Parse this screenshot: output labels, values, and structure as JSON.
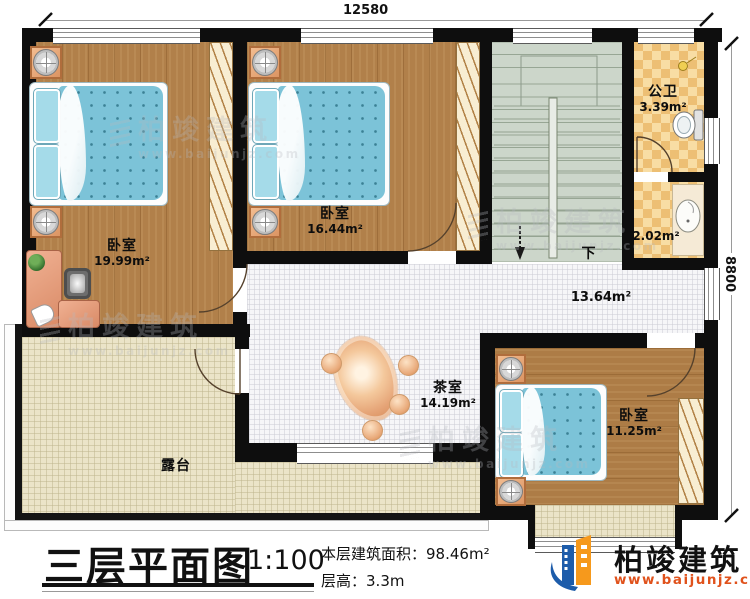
{
  "dimensions": {
    "width": "12580",
    "height": "8800"
  },
  "rooms": {
    "bedroom1": {
      "label": "卧室",
      "area": "19.99m²"
    },
    "bedroom2": {
      "label": "卧室",
      "area": "16.44m²"
    },
    "bedroom3": {
      "label": "卧室",
      "area": "11.25m²"
    },
    "bathroom": {
      "label": "公卫",
      "area": "3.39m²"
    },
    "vestibule": {
      "area": "2.02m²"
    },
    "hall": {
      "area": "13.64m²"
    },
    "tearoom": {
      "label": "茶室",
      "area": "14.19m²"
    },
    "terrace": {
      "label": "露台"
    },
    "stairs": {
      "down_label": "下"
    }
  },
  "title_block": {
    "title": "三层平面图",
    "scale": "1:100",
    "area_label": "本层建筑面积：",
    "area_value": "98.46m²",
    "height_label": "层高：",
    "height_value": "3.3m"
  },
  "logo": {
    "name": "柏竣建筑",
    "website": "www.baijunjz.com"
  },
  "watermark": {
    "name": "柏竣建筑",
    "website": "www.baijunjz.com"
  },
  "colors": {
    "wall": "#0e0e0e",
    "wood_floor": "#b1804a",
    "bed_blue": "#7cc3d8",
    "bath_tile": "#edbf74",
    "terrace_tile": "#ebe4c8",
    "logo_blue": "#1d5caa",
    "logo_orange": "#f6991c",
    "website_orange": "#e0521c"
  }
}
